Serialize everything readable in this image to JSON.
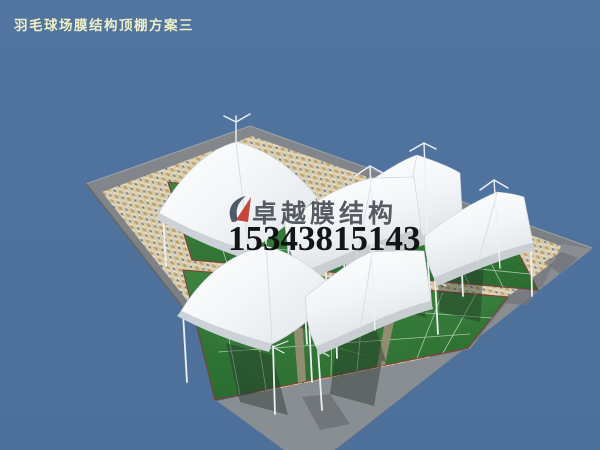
{
  "meta": {
    "canvas_width": 600,
    "canvas_height": 450,
    "scene_type": "3d-architectural-render"
  },
  "header": {
    "title": "羽毛球场膜结构顶棚方案三"
  },
  "watermark": {
    "brand": "卓越膜结构",
    "phone": "15343815143",
    "logo_icon": "membrane-swoosh-logo"
  },
  "scene": {
    "canopy_count": 6,
    "court_band_count": 2,
    "colors": {
      "sky_background": "#5174a0",
      "plaza_border_gray": "#7b8084",
      "apron_gray": "#898e93",
      "walkway_khaki": "#9a9179",
      "mosaic_base": "#d8cfb0",
      "mosaic_blue_accent": "#66738c",
      "mosaic_tan_accent": "#c4a471",
      "court_green": "#2f7d36",
      "court_line": "#e9f1e9",
      "court_border_red": "#7c4237",
      "membrane_white": "#fafbfc",
      "membrane_shade": "#c9ced3",
      "pole_white": "#edf0f3",
      "canopy_shadow": "#243228",
      "title_text": "#eef0c6",
      "brand_text": "#41474f",
      "phone_text": "#0d0d0d",
      "logo_red": "#c23b2e",
      "logo_dark": "#3d4a5a"
    }
  }
}
